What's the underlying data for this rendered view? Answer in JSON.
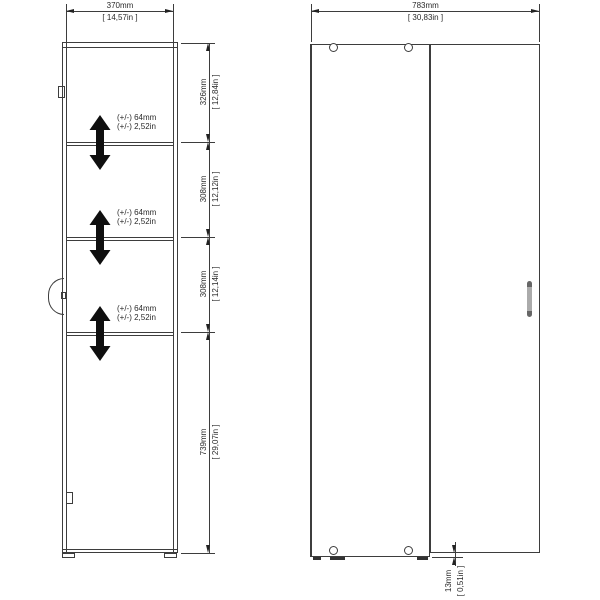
{
  "drawing": {
    "front_view": {
      "width_dim": {
        "mm": "370mm",
        "inch": "[ 14,57in ]"
      },
      "height_sections": [
        {
          "mm": "326mm",
          "inch": "[ 12,84in ]"
        },
        {
          "mm": "308mm",
          "inch": "[ 12,12in ]"
        },
        {
          "mm": "308mm",
          "inch": "[ 12,14in ]"
        },
        {
          "mm": "739mm",
          "inch": "[ 29,07in ]"
        }
      ],
      "shelf_adjustability": {
        "mm": "(+/-) 64mm",
        "inch": "(+/-) 2,52in"
      }
    },
    "side_view": {
      "width_dim": {
        "mm": "783mm",
        "inch": "[ 30,83in ]"
      },
      "plinth_dim": {
        "mm": "13mm",
        "inch": "[ 0,51in ]"
      }
    },
    "colors": {
      "line": "#3d3d3d",
      "text": "#2a2a2a",
      "arrow": "#0f0f0f",
      "background": "#ffffff",
      "handle": "#ababab"
    }
  }
}
